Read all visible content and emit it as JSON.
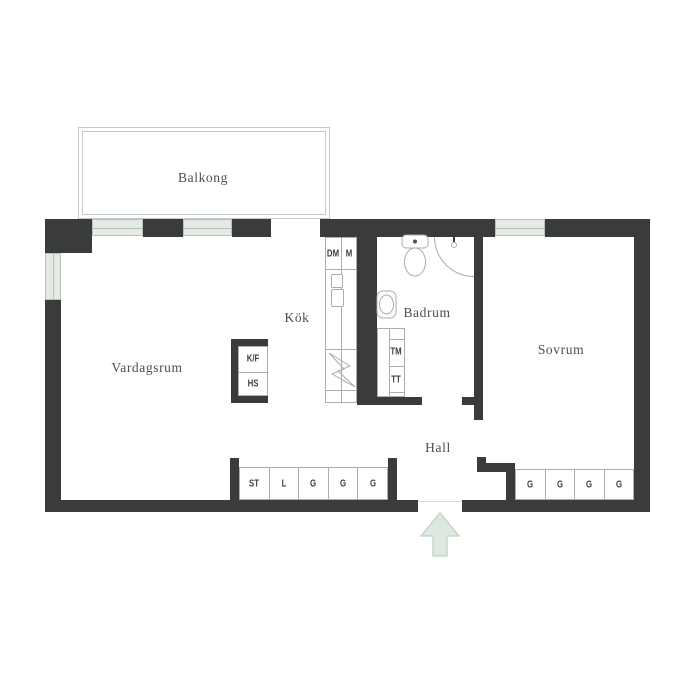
{
  "colors": {
    "wall": "#3a3b3c",
    "winfill": "#e3ebe4",
    "winborder": "#b7c2b9",
    "line": "#a9aeab",
    "balcony": "#c6cbc9",
    "label": "#4e4e50",
    "unitlabel": "#3f3f41",
    "arrowfill": "#dde9df",
    "arrowborder": "#c6d6c9",
    "threshold": "#dadada"
  },
  "rooms": {
    "balcony": "Balkong",
    "living_room": "Vardagsrum",
    "kitchen": "Kök",
    "bathroom": "Badrum",
    "bedroom": "Sovrum",
    "hall": "Hall"
  },
  "kitchen_units": {
    "dishwasher": "DM",
    "machine": "M",
    "fridge_freezer": "K/F",
    "tall_cabinet": "HS"
  },
  "laundry_units": {
    "washing_machine": "TM",
    "tumble_dryer": "TT"
  },
  "closets_left": [
    "ST",
    "L",
    "G",
    "G",
    "G"
  ],
  "closets_right": [
    "G",
    "G",
    "G",
    "G"
  ],
  "icons": {
    "entrance_arrow": "arrow-up",
    "toilet": "toilet",
    "sink": "washbasin",
    "stove": "lightning-bolt",
    "shower": "shower-corner"
  }
}
